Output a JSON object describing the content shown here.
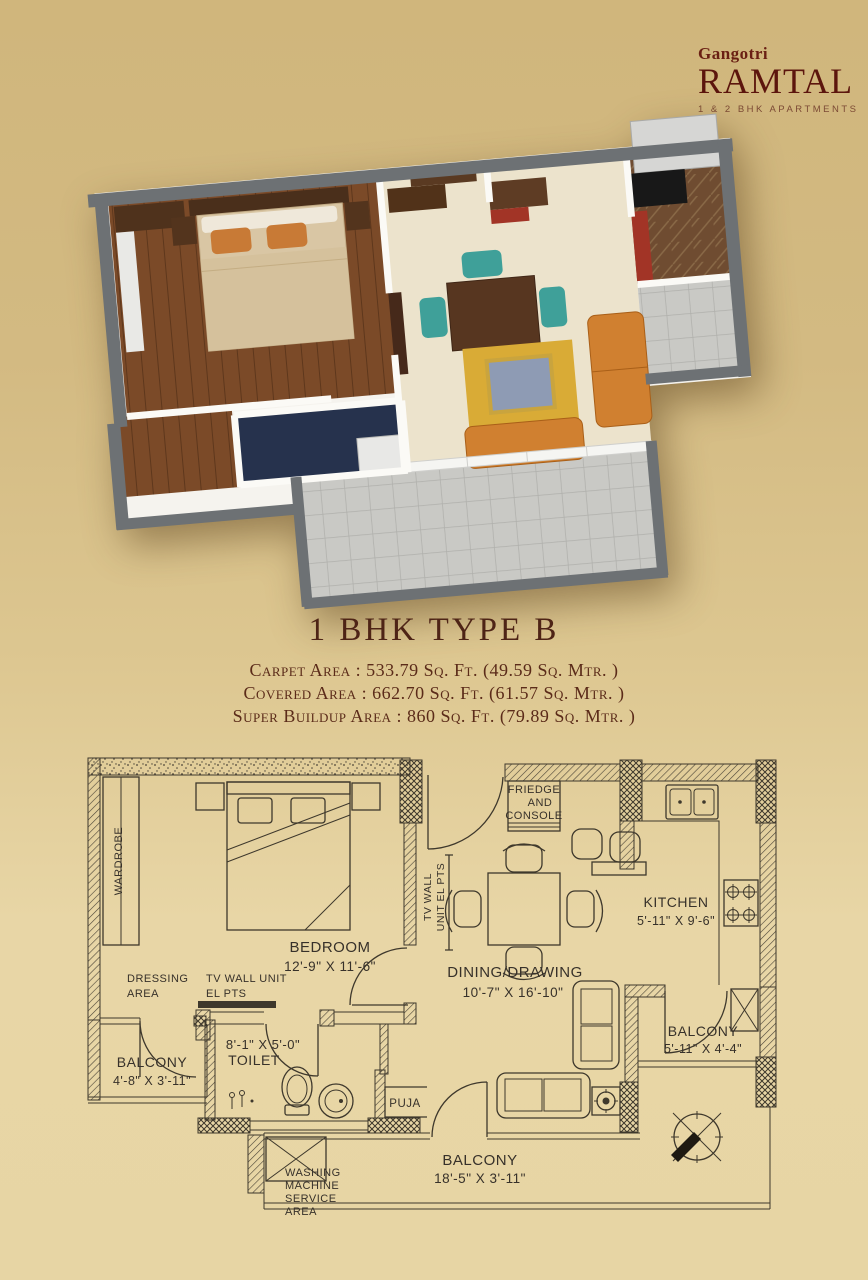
{
  "brand": {
    "name_small": "Gangotri",
    "name_main": "RAMTAL",
    "tagline": "1 & 2 BHK APARTMENTS"
  },
  "unit": {
    "title": "1 BHK TYPE B",
    "area_lines": [
      "Carpet Area :  533.79 Sq. Ft.  (49.59 Sq. Mtr. )",
      "Covered Area : 662.70 Sq. Ft.  (61.57 Sq. Mtr. )",
      "Super Buildup Area : 860 Sq. Ft.  (79.89 Sq. Mtr. )"
    ]
  },
  "plan": {
    "wardrobe": "WARDROBE",
    "bedroom_name": "BEDROOM",
    "bedroom_dims": "12'-9\" X 11'-6\"",
    "dressing_1": "DRESSING",
    "dressing_2": "AREA",
    "tv_unit_1": "TV WALL UNIT",
    "tv_unit_2": "EL PTS",
    "tv_wall_v1": "TV WALL",
    "tv_wall_v2": "UNIT EL PTS",
    "toilet_dims": "8'-1\" X 5'-0\"",
    "toilet_name": "TOILET",
    "balcony_left_name": "BALCONY",
    "balcony_left_dims": "4'-8\" X 3'-11\"",
    "fridge_1": "FRIEDGE",
    "fridge_2": "AND",
    "fridge_3": "CONSOLE",
    "dining_name": "DINING/DRAWING",
    "dining_dims": "10'-7\" X 16'-10\"",
    "kitchen_name": "KITCHEN",
    "kitchen_dims": "5'-11\" X 9'-6\"",
    "balcony_right_name": "BALCONY",
    "balcony_right_dims": "5'-11\" X 4'-4\"",
    "puja": "PUJA",
    "balcony_bottom_name": "BALCONY",
    "balcony_bottom_dims": "18'-5\" X 3'-11\"",
    "washing_1": "WASHING",
    "washing_2": "MACHINE",
    "washing_3": "SERVICE",
    "washing_4": "AREA"
  },
  "colors": {
    "brand_maroon": "#5c150d",
    "title_brown": "#4e2416",
    "background_top": "#d0b67c",
    "background_bottom": "#e8d6a6",
    "plan_line": "#3e382c",
    "wall_gray_3d": "#6d7174",
    "wood_floor_3d": "#7b4a28",
    "sofa_orange_3d": "#d08030",
    "chair_teal_3d": "#3fa099",
    "toilet_navy_3d": "#26324d"
  }
}
